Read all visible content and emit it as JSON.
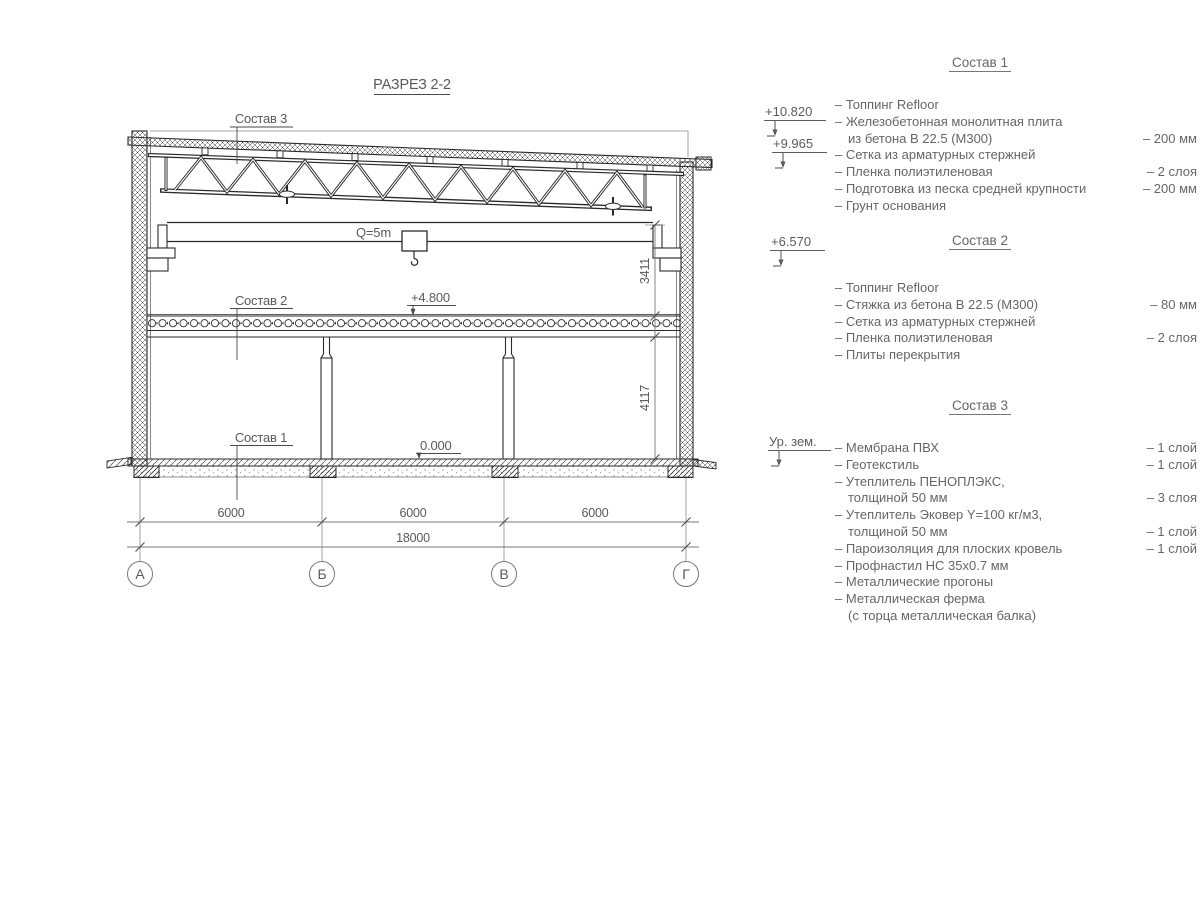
{
  "title": "РАЗРЕЗ 2-2",
  "colors": {
    "line": "#2b2b2b",
    "dim": "#787878",
    "text": "#5a5a5a"
  },
  "drawing": {
    "labels": {
      "sostav3": "Состав 3",
      "sostav2": "Состав 2",
      "sostav1": "Состав 1",
      "crane_capacity": "Q=5m",
      "elev_floor2": "+4.800",
      "elev_zero": "0.000"
    },
    "dims": {
      "span_ab": "6000",
      "span_bv": "6000",
      "span_vg": "6000",
      "total": "18000",
      "height_upper": "3411",
      "height_lower": "4117"
    },
    "axes": {
      "a": "А",
      "b": "Б",
      "v": "В",
      "g": "Г"
    }
  },
  "legend": {
    "elevation_marks": [
      {
        "label": "+10.820"
      },
      {
        "label": "+9.965"
      },
      {
        "label": "+6.570"
      },
      {
        "label": "Ур. зем."
      }
    ],
    "sections": [
      {
        "title": "Состав 1",
        "items": [
          {
            "text": "– Топпинг Refloor",
            "value": ""
          },
          {
            "text": "– Железобетонная монолитная плита",
            "value": ""
          },
          {
            "text": "из бетона В 22.5 (М300)",
            "value": "– 200 мм"
          },
          {
            "text": "– Сетка из арматурных стержней",
            "value": ""
          },
          {
            "text": "– Пленка полиэтиленовая",
            "value": "– 2 слоя"
          },
          {
            "text": "– Подготовка из песка средней крупности",
            "value": "– 200 мм"
          },
          {
            "text": "– Грунт основания",
            "value": ""
          }
        ]
      },
      {
        "title": "Состав 2",
        "items": [
          {
            "text": "– Топпинг Refloor",
            "value": ""
          },
          {
            "text": "– Стяжка из бетона В 22.5 (М300)",
            "value": "– 80 мм"
          },
          {
            "text": "– Сетка из арматурных стержней",
            "value": ""
          },
          {
            "text": "– Пленка полиэтиленовая",
            "value": "– 2 слоя"
          },
          {
            "text": "– Плиты перекрытия",
            "value": ""
          }
        ]
      },
      {
        "title": "Состав 3",
        "items": [
          {
            "text": "– Мембрана ПВХ",
            "value": "– 1 слой"
          },
          {
            "text": "– Геотекстиль",
            "value": "– 1 слой"
          },
          {
            "text": "– Утеплитель ПЕНОПЛЭКС,",
            "value": ""
          },
          {
            "text": "толщиной 50 мм",
            "value": "– 3 слоя"
          },
          {
            "text": "– Утеплитель Эковер Y=100 кг/м3,",
            "value": ""
          },
          {
            "text": "толщиной 50 мм",
            "value": "– 1 слой"
          },
          {
            "text": "– Пароизоляция для плоских кровель",
            "value": "– 1 слой"
          },
          {
            "text": "– Профнастил НС 35х0.7 мм",
            "value": ""
          },
          {
            "text": "– Металлические прогоны",
            "value": ""
          },
          {
            "text": "– Металлическая ферма",
            "value": ""
          },
          {
            "text": "(с торца металлическая балка)",
            "value": ""
          }
        ]
      }
    ]
  }
}
